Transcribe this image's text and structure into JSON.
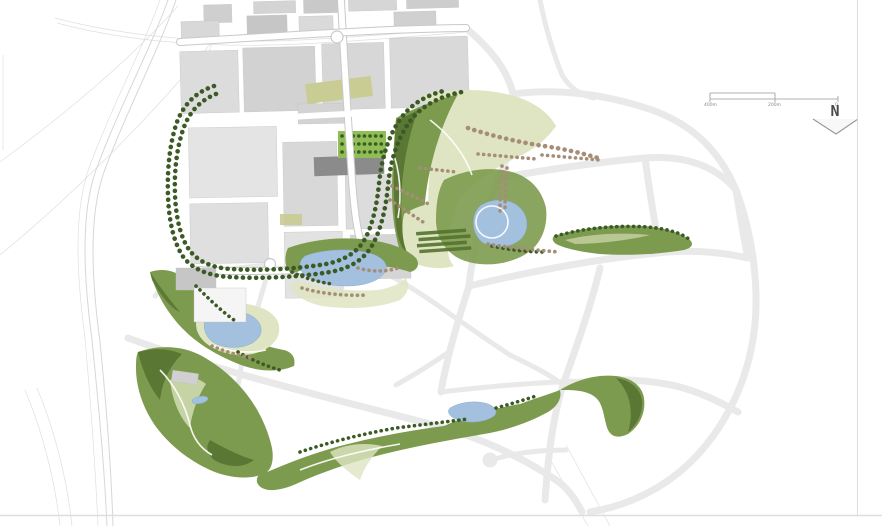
{
  "annotations": {
    "north_label": "N",
    "scale_bar": {
      "left_label": "400m",
      "mid_label": "200m",
      "right_label": "0"
    }
  },
  "palette": {
    "sheet-bg": "#ffffff",
    "rail-gray": "#d7d7d7",
    "road-gray": "#e9e9e9",
    "block-dark": "#8b8b8b",
    "olive": "#c9cc93",
    "plaza-green": "#8fbe55",
    "park-green": "#7d9b4e",
    "park-dark": "#54722f",
    "lawn": "#dfe5c2",
    "water": "#a3c0de",
    "tree-dark": "#3c5a26",
    "tree-brown": "#a58d77",
    "path-white": "#ffffff",
    "border": "#dedede",
    "ink": "#4a4a4a"
  }
}
